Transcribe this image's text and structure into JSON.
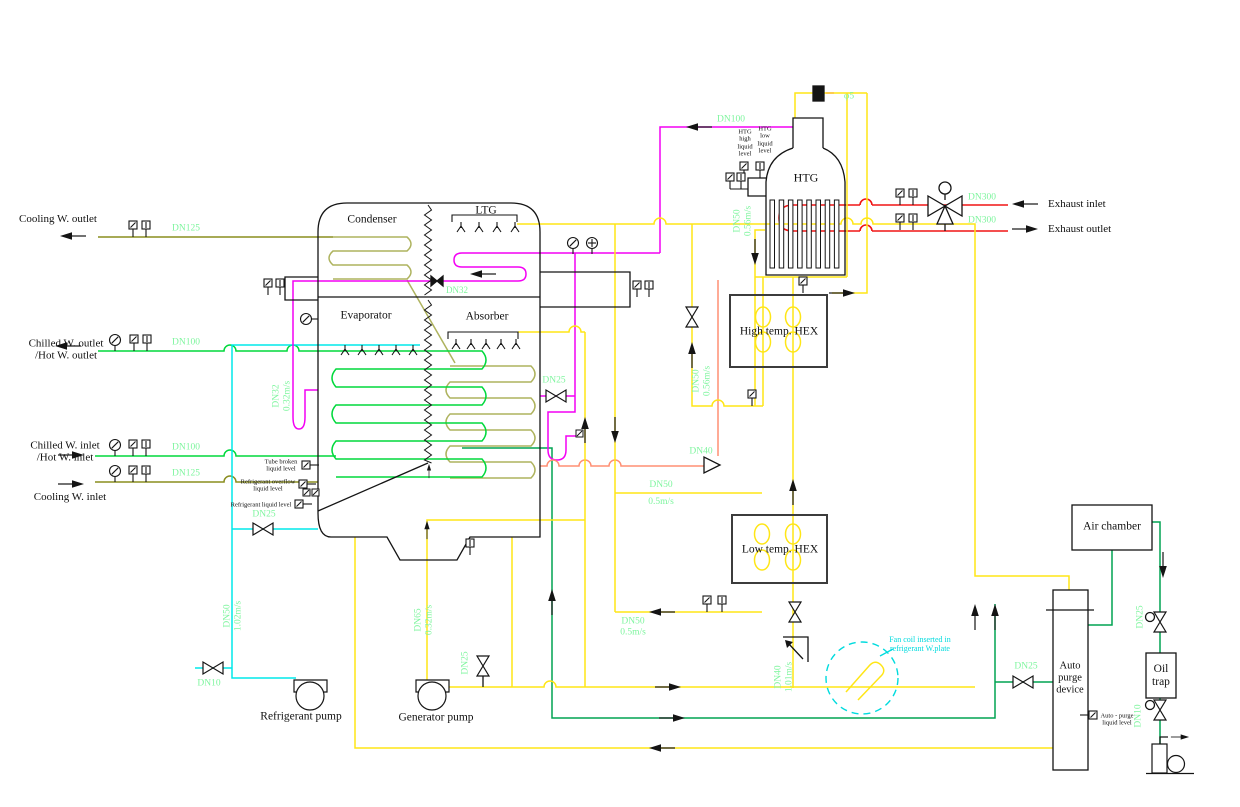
{
  "colors": {
    "pipe_yellow": "#ffe616",
    "pipe_magenta": "#f400f4",
    "pipe_red": "#f01515",
    "pipe_cyan": "#00e8ea",
    "pipe_green_chilled": "#00d93c",
    "pipe_green_purge": "#00a352",
    "pipe_olive_cooling": "#8a8d1f",
    "pipe_coil_olive": "#aeb35e",
    "pipe_orange": "#ff8f73",
    "label_green": "#7ef59e",
    "line_black": "#141414",
    "note_cyan": "#00dbde"
  },
  "labels": {
    "io": [
      {
        "id": "cooling-w-outlet-label",
        "text": "Cooling W. outlet",
        "x": 58,
        "y": 219
      },
      {
        "id": "chilled-w-outlet-label",
        "text": "Chilled W. outlet\n/Hot W. outlet",
        "x": 66,
        "y": 350
      },
      {
        "id": "chilled-w-inlet-label",
        "text": "Chilled W. inlet\n/Hot W. inlet",
        "x": 65,
        "y": 452
      },
      {
        "id": "cooling-w-inlet-label",
        "text": "Cooling W. inlet",
        "x": 70,
        "y": 497
      },
      {
        "id": "exhaust-inlet-label",
        "text": "Exhaust inlet",
        "x": 1048,
        "y": 204,
        "align": "left"
      },
      {
        "id": "exhaust-outlet-label",
        "text": "Exhaust outlet",
        "x": 1048,
        "y": 229,
        "align": "left"
      }
    ],
    "equipment": [
      {
        "id": "condenser-label",
        "text": "Condenser",
        "x": 372,
        "y": 220
      },
      {
        "id": "ltg-label",
        "text": "LTG",
        "x": 486,
        "y": 211
      },
      {
        "id": "evaporator-label",
        "text": "Evaporator",
        "x": 366,
        "y": 316
      },
      {
        "id": "absorber-label",
        "text": "Absorber",
        "x": 487,
        "y": 317
      },
      {
        "id": "htg-label",
        "text": "HTG",
        "x": 806,
        "y": 178,
        "size": 12
      },
      {
        "id": "high-temp-hex-label",
        "text": "High temp. HEX",
        "x": 779,
        "y": 332
      },
      {
        "id": "low-temp-hex-label",
        "text": "Low temp. HEX",
        "x": 780,
        "y": 550
      },
      {
        "id": "air-chamber-label",
        "text": "Air chamber",
        "x": 1112,
        "y": 527
      },
      {
        "id": "auto-purge-device-label",
        "text": "Auto\npurge\ndevice",
        "x": 1070,
        "y": 678,
        "size": 10.5
      },
      {
        "id": "oil-trap-label",
        "text": "Oil\ntrap",
        "x": 1161,
        "y": 676
      },
      {
        "id": "refrigerant-pump-label",
        "text": "Refrigerant pump",
        "x": 301,
        "y": 717
      },
      {
        "id": "generator-pump-label",
        "text": "Generator pump",
        "x": 436,
        "y": 718
      }
    ],
    "pipes": [
      {
        "id": "dn125-cooling-outlet",
        "text": "DN125",
        "x": 186,
        "y": 229
      },
      {
        "id": "dn100-chilled-outlet",
        "text": "DN100",
        "x": 186,
        "y": 343
      },
      {
        "id": "dn100-chilled-inlet",
        "text": "DN100",
        "x": 186,
        "y": 448
      },
      {
        "id": "dn125-cooling-inlet",
        "text": "DN125",
        "x": 186,
        "y": 474
      },
      {
        "id": "dn32-condensate",
        "text": "DN32",
        "x": 457,
        "y": 290,
        "size": 9
      },
      {
        "id": "dn25-absorber",
        "text": "DN25",
        "x": 554,
        "y": 381
      },
      {
        "id": "dn25-refrigerant",
        "text": "DN25",
        "x": 264,
        "y": 515
      },
      {
        "id": "dn32-032",
        "text": "DN32\n0.32m/s",
        "x": 282,
        "y": 396,
        "rotate": -90
      },
      {
        "id": "dn50-102",
        "text": "DN50\n1.02m/s",
        "x": 233,
        "y": 616,
        "rotate": -90
      },
      {
        "id": "dn10-refrigerant",
        "text": "DN10",
        "x": 209,
        "y": 684
      },
      {
        "id": "dn65-032",
        "text": "DN65\n0.32m/s",
        "x": 424,
        "y": 620,
        "rotate": -90
      },
      {
        "id": "dn25-generator",
        "text": "DN25",
        "x": 466,
        "y": 663,
        "rotate": -90
      },
      {
        "id": "dn50-056-htg",
        "text": "DN50\n0.56m/s",
        "x": 743,
        "y": 221,
        "rotate": -90
      },
      {
        "id": "dn50-056-hex",
        "text": "DN50\n0.56m/s",
        "x": 702,
        "y": 381,
        "rotate": -90
      },
      {
        "id": "dn40-drain",
        "text": "DN40",
        "x": 701,
        "y": 452
      },
      {
        "id": "dn50-05-upper",
        "text": "DN50\n0.5m/s",
        "x": 661,
        "y": 494,
        "lh": 1.8
      },
      {
        "id": "dn50-05-lower",
        "text": "DN50\n0.5m/s",
        "x": 633,
        "y": 627
      },
      {
        "id": "dn40-101",
        "text": "DN40\n1.01m/s",
        "x": 784,
        "y": 677,
        "rotate": -90
      },
      {
        "id": "dn25-purge",
        "text": "DN25",
        "x": 1026,
        "y": 667
      },
      {
        "id": "dn25-oil",
        "text": "DN25",
        "x": 1141,
        "y": 617,
        "rotate": -90
      },
      {
        "id": "dn10-oil",
        "text": "DN10",
        "x": 1139,
        "y": 716,
        "rotate": -90
      },
      {
        "id": "dn300-inlet",
        "text": "DN300",
        "x": 982,
        "y": 198
      },
      {
        "id": "dn300-outlet",
        "text": "DN300",
        "x": 982,
        "y": 221
      },
      {
        "id": "phi5",
        "text": "φ5",
        "x": 849,
        "y": 97
      },
      {
        "id": "dn100-htg",
        "text": "DN100",
        "x": 731,
        "y": 120
      }
    ],
    "levels": [
      {
        "id": "htg-high-liquid-level",
        "text": "HTG\nhigh\nliquid\nlevel",
        "x": 745,
        "y": 143
      },
      {
        "id": "htg-low-liquid-level",
        "text": "HTG\nlow\nliquid\nlevel",
        "x": 765,
        "y": 140
      },
      {
        "id": "tube-broken-liquid-level",
        "text": "Tube broken\nliquid level",
        "x": 281,
        "y": 466
      },
      {
        "id": "refrigerant-overflow-liquid-level",
        "text": "Refrigerant overflow\nliquid level",
        "x": 268,
        "y": 486
      },
      {
        "id": "refrigerant-liquid-level",
        "text": "Refrigerant liquid level",
        "x": 261,
        "y": 505
      },
      {
        "id": "auto-purge-liquid-level",
        "text": "Auto - purge\nliquid level",
        "x": 1117,
        "y": 720
      }
    ],
    "notes": [
      {
        "id": "fan-coil-note",
        "text": "Fan coil inserted in\nrefrigerant W.plate",
        "x": 920,
        "y": 645
      }
    ]
  }
}
